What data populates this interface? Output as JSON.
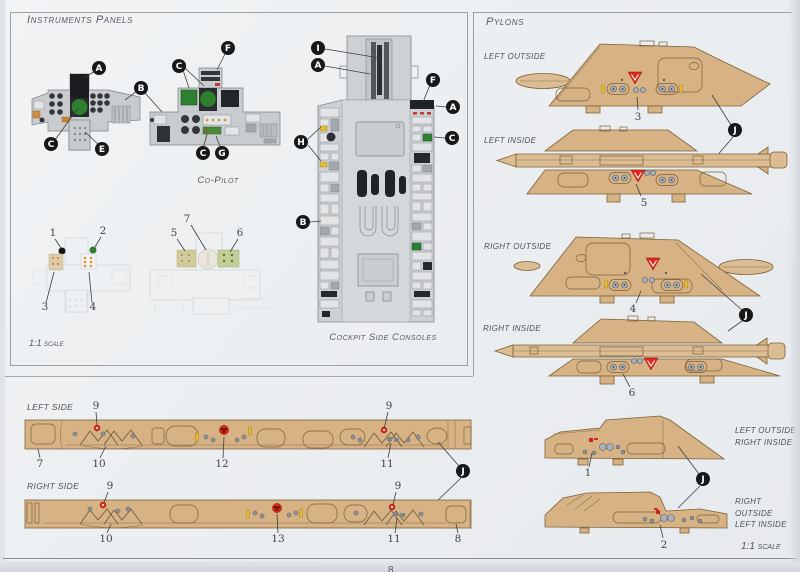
{
  "page": {
    "number": "8"
  },
  "instruments": {
    "title": "Instruments Panels",
    "copilot_label": "Co-Pilot",
    "console_caption": "Cockpit Side Consoles",
    "scale_label": "1:1 scale"
  },
  "pylons": {
    "title": "Pylons",
    "rows": [
      {
        "label": "LEFT OUTSIDE",
        "number": "3"
      },
      {
        "label": "LEFT INSIDE",
        "number": "5"
      },
      {
        "label": "RIGHT OUTSIDE",
        "number": "4"
      },
      {
        "label": "RIGHT INSIDE",
        "number": "6"
      }
    ],
    "small_rows": [
      {
        "line1": "LEFT OUTSIDE",
        "line2": "RIGHT INSIDE",
        "number": "1"
      },
      {
        "line1": "RIGHT OUTSIDE",
        "line2": "LEFT INSIDE",
        "number": "2"
      }
    ],
    "scale_label": "1:1 scale"
  },
  "sides": {
    "left_label": "LEFT SIDE",
    "right_label": "RIGHT SIDE"
  },
  "letters": {
    "A": "A",
    "B": "B",
    "C": "C",
    "E": "E",
    "F": "F",
    "G": "G",
    "H": "H",
    "I": "I",
    "J": "J"
  },
  "numbers": {
    "n1": "1",
    "n2": "2",
    "n3": "3",
    "n4": "4",
    "n5": "5",
    "n6": "6",
    "n7": "7",
    "n8": "8",
    "n9": "9",
    "n10": "10",
    "n11": "11",
    "n12": "12",
    "n13": "13"
  },
  "colors": {
    "pylon_tan": "#d7b285",
    "decal_red": "#e02818",
    "decal_yellow": "#e7bb2f",
    "screen_green": "#2e8030",
    "paper": "#eef0f3"
  }
}
